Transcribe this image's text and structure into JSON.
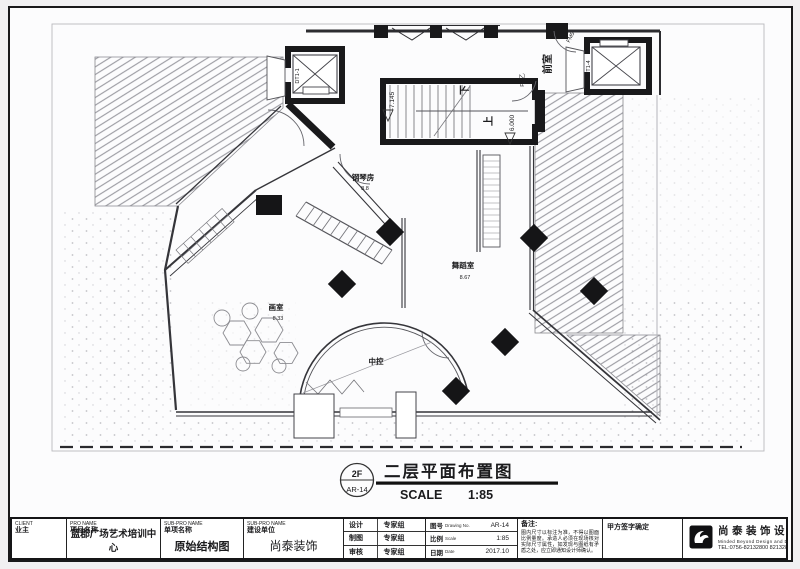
{
  "sheet": {
    "tag_top": "2F",
    "tag_code": "AR-14",
    "title": "二层平面布置图",
    "scale_word": "SCALE",
    "scale_value": "1:85"
  },
  "plan": {
    "piano_name": "钢琴房",
    "piano_area": "8.8",
    "dance_name": "舞蹈室",
    "dance_area": "8.67",
    "art_name": "画室",
    "art_area": "8.33",
    "control_name": "中控",
    "vestibule": "前室",
    "fm_top": "FM5",
    "fm_side": "FM乙",
    "stair_down": "下",
    "stair_up": "上",
    "level_low": "-7.145",
    "level_high": "6.000",
    "elev_left": "DT1-1",
    "elev_right": "DT1-4"
  },
  "titleblock": {
    "client": {
      "en": "CLIENT",
      "cn": "业主"
    },
    "project": {
      "en": "PRO NAME",
      "cn": "项目名称",
      "value": "蓝郡广场艺术培训中心"
    },
    "subproject": {
      "en": "SUB-PRO NAME",
      "cn": "单项名称",
      "value": "原始结构图"
    },
    "builder": {
      "en": "SUB-PRO NAME",
      "cn": "建设单位",
      "value": "尚泰装饰"
    },
    "roles": [
      {
        "label": "设计",
        "value": "专家组"
      },
      {
        "label": "制图",
        "value": "专家组"
      },
      {
        "label": "审核",
        "value": "专家组"
      }
    ],
    "meta": [
      {
        "label_cn": "图号",
        "label_en": "Drawing No.",
        "value": "AR-14"
      },
      {
        "label_cn": "比例",
        "label_en": "Scale",
        "value": "1:85"
      },
      {
        "label_cn": "日期",
        "label_en": "Date",
        "value": "2017.10"
      }
    ],
    "remark": {
      "label": "备注:",
      "text": "图内尺寸以标注为准，不得以图面比例量度。承造人必须在现场核对实际尺寸属性，如发现与图纸有矛盾之处，应立即通知设计师确认。"
    },
    "sign": "甲方签字确定",
    "brand": {
      "name": "尚泰装饰设计",
      "sub": "Minded Beyond Design and Decoration",
      "tel": "TEL:0756-82132800   82132810"
    }
  },
  "colors": {
    "ink": "#19191b",
    "wall": "#35353a",
    "hatch": "#8f8f96",
    "paper": "#fcfcfd"
  }
}
